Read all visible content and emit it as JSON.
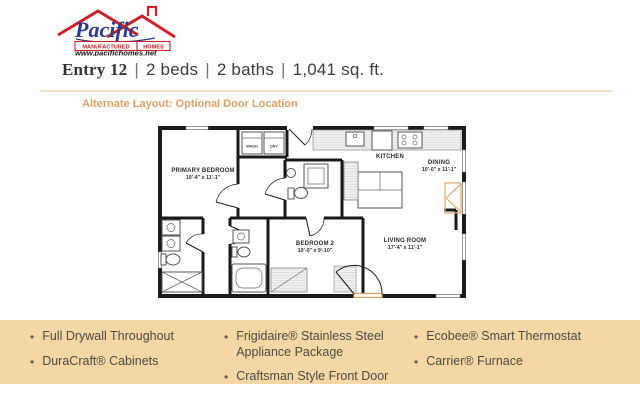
{
  "logo": {
    "brand": "Pacific",
    "tagline_left": "MANUFACTURED",
    "tagline_right": "HOMES",
    "website": "www.pacifichomes.net"
  },
  "header": {
    "model": "Entry 12",
    "sep": "|",
    "beds": "2 beds",
    "baths": "2 baths",
    "sqft": "1,041 sq. ft."
  },
  "plan_note": "Alternate Layout: Optional Door Location",
  "floor_plan": {
    "rooms": {
      "primary_bedroom": {
        "name": "PRIMARY BEDROOM",
        "dims": "10'-4\" x 11'-1\""
      },
      "kitchen": {
        "name": "KITCHEN"
      },
      "dining": {
        "name": "DINING",
        "dims": "10'-0\" x 11'-1\""
      },
      "living_room": {
        "name": "LIVING ROOM",
        "dims": "17'-4\" x 11'-1\""
      },
      "bedroom_2": {
        "name": "BEDROOM 2",
        "dims": "10'-0\" x 9'-10\""
      }
    },
    "appliances": {
      "wash": "WASH",
      "dry": "DRY"
    }
  },
  "features": {
    "col1": [
      "Full Drywall Throughout",
      "DuraCraft® Cabinets"
    ],
    "col2": [
      "Frigidaire® Stainless Steel Appliance Package",
      "Craftsman Style Front Door"
    ],
    "col3": [
      "Ecobee® Smart Thermostat",
      "Carrier® Furnace"
    ]
  },
  "colors": {
    "accent_orange": "#e1a163",
    "band_bg": "#f4d7a4",
    "logo_red": "#cf2128",
    "logo_blue": "#2d3a8d",
    "optional_door": "#e0b074"
  }
}
